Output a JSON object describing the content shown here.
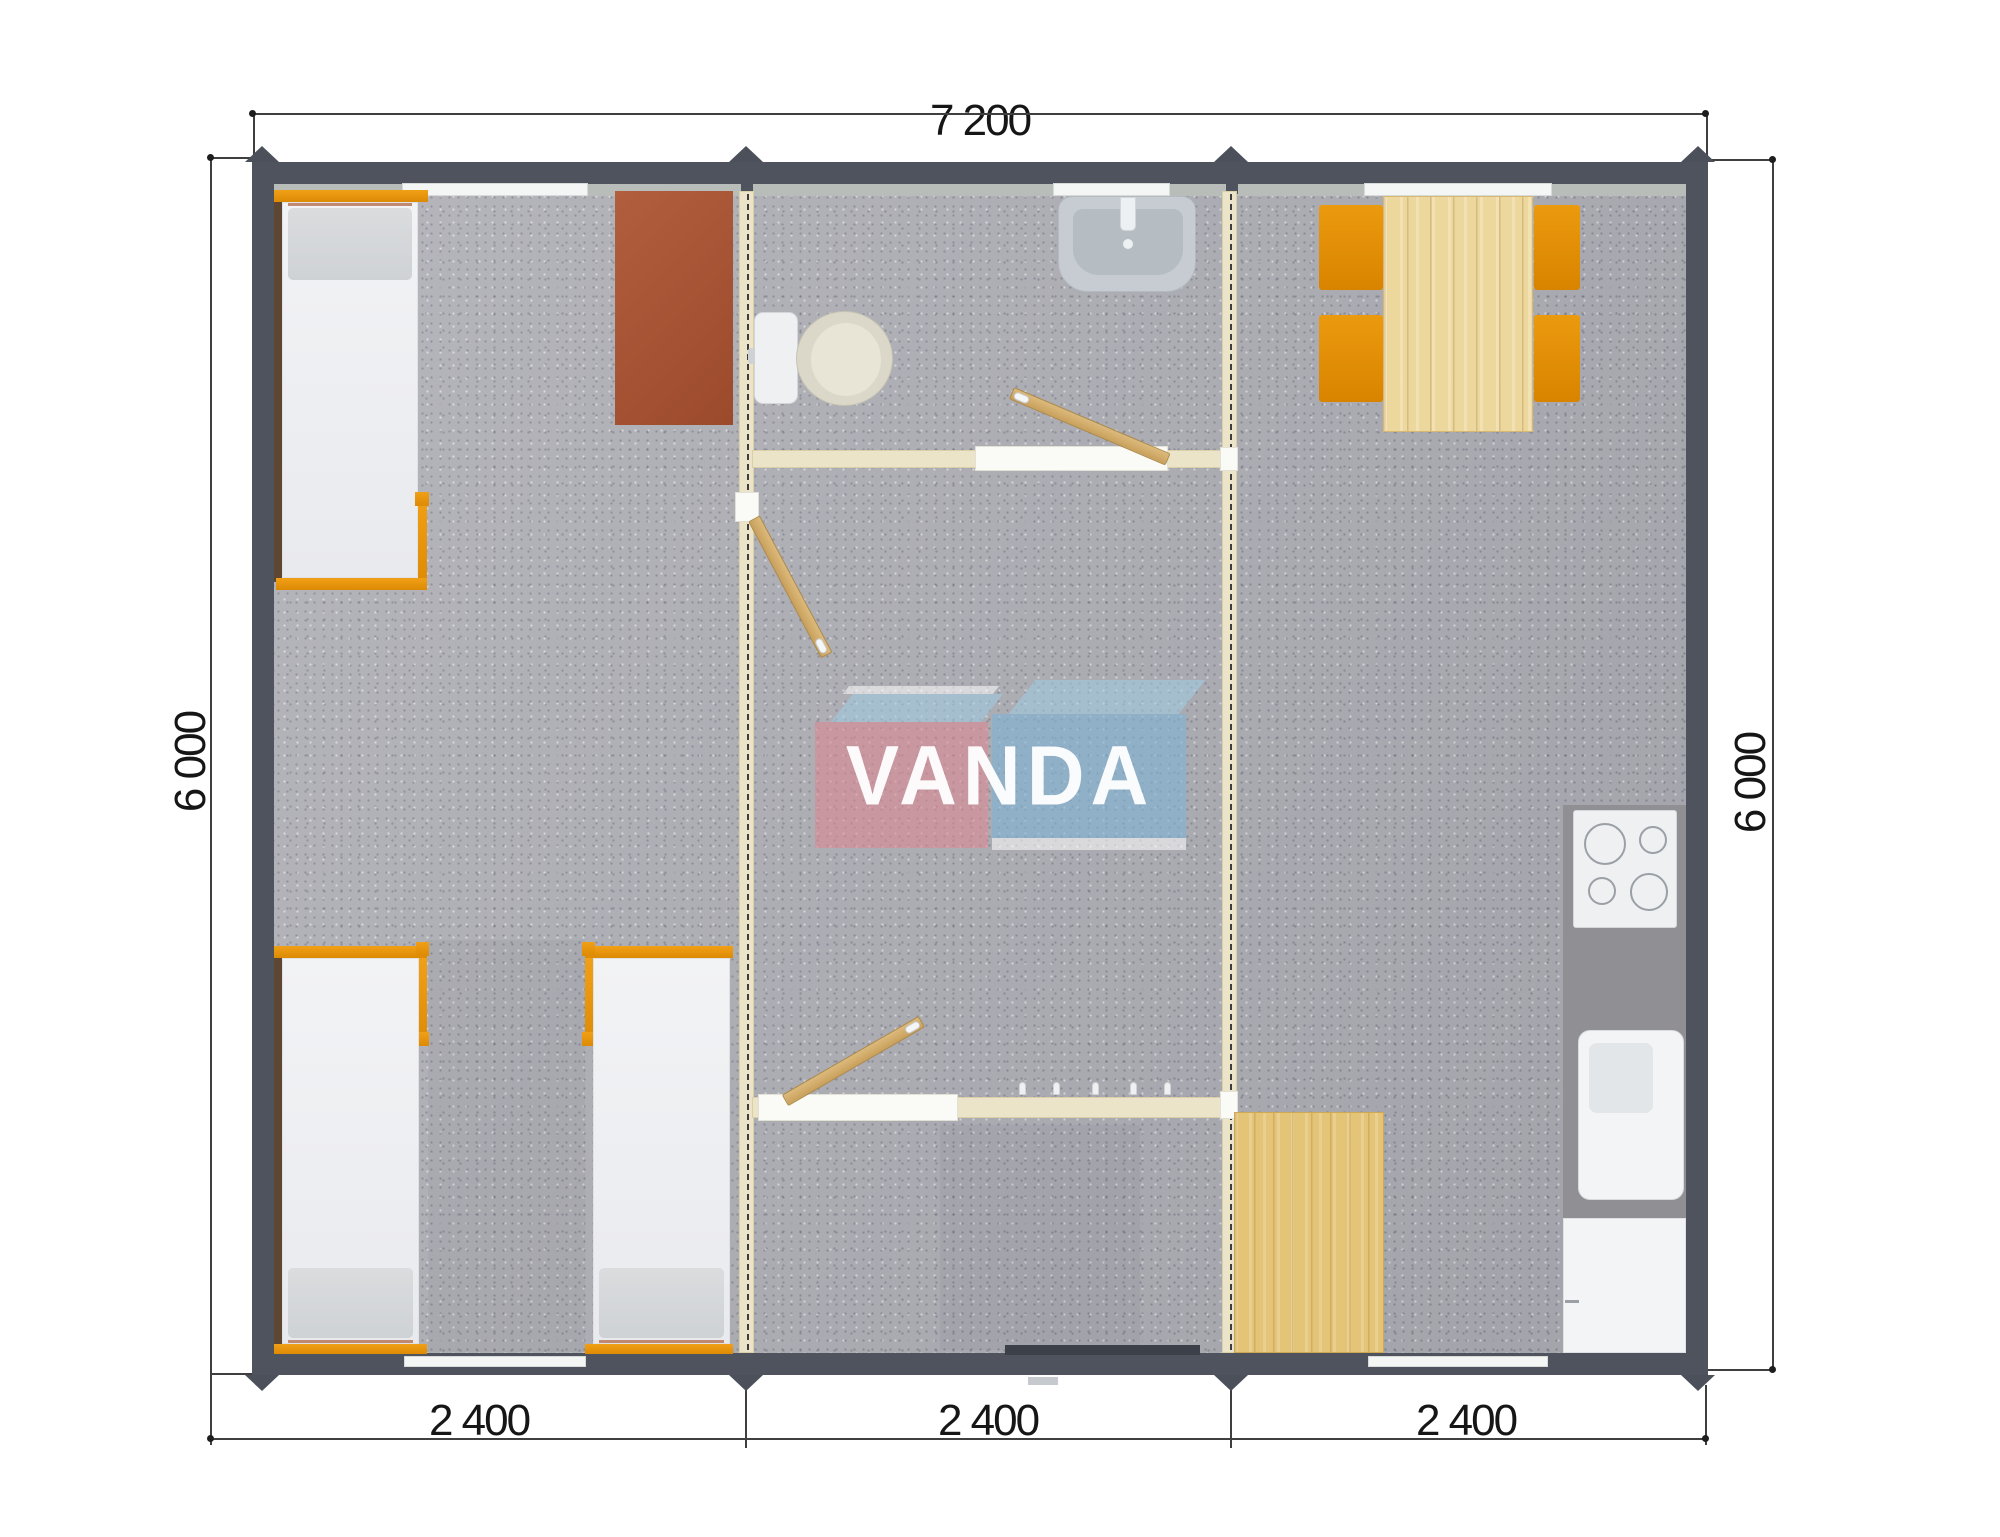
{
  "dimensions": {
    "top_width": "7 200",
    "left_height": "6 000",
    "right_height": "6 000",
    "modules": [
      "2 400",
      "2 400",
      "2 400"
    ]
  },
  "watermark": {
    "text": "VANDA"
  },
  "colors": {
    "wall": "#4e535d",
    "partition_cream": "#ece4c8",
    "accent_orange": "#e28e06",
    "wood_light": "#e4c477",
    "desk_brown": "#a5542f",
    "carpet_gray": "#adadb4",
    "logo_red": "#dd8893",
    "logo_blue": "#7fb3d5"
  }
}
